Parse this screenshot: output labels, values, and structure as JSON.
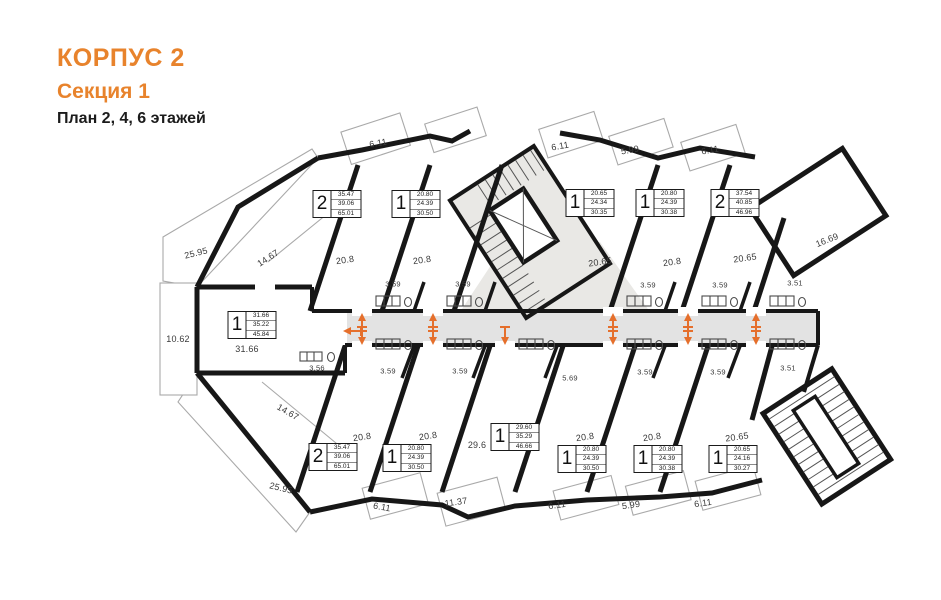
{
  "header": {
    "building": "КОРПУС 2",
    "section": "Секция 1",
    "plan": "План 2, 4, 6 этажей",
    "accent_color": "#E8832C"
  },
  "plan": {
    "arrow_color": "#E56F2C",
    "corridor_color": "#E3E3E3",
    "stair_color": "#E9E8E5",
    "wall_color": "#171717",
    "apartments": [
      {
        "rooms": "2",
        "areas": [
          "35.47",
          "39.06",
          "65.01"
        ],
        "x": 337,
        "y": 204
      },
      {
        "rooms": "1",
        "areas": [
          "20.80",
          "24.39",
          "30.50"
        ],
        "x": 416,
        "y": 204
      },
      {
        "rooms": "1",
        "areas": [
          "20.65",
          "24.34",
          "30.35"
        ],
        "x": 590,
        "y": 203
      },
      {
        "rooms": "1",
        "areas": [
          "20.80",
          "24.39",
          "30.38"
        ],
        "x": 660,
        "y": 203
      },
      {
        "rooms": "2",
        "areas": [
          "37.54",
          "40.85",
          "46.96"
        ],
        "x": 735,
        "y": 203
      },
      {
        "rooms": "1",
        "areas": [
          "31.66",
          "35.22",
          "45.84"
        ],
        "x": 252,
        "y": 325
      },
      {
        "rooms": "1",
        "areas": [
          "29.60",
          "35.29",
          "46.66"
        ],
        "x": 515,
        "y": 437
      },
      {
        "rooms": "2",
        "areas": [
          "35.47",
          "39.06",
          "65.01"
        ],
        "x": 333,
        "y": 457
      },
      {
        "rooms": "1",
        "areas": [
          "20.80",
          "24.39",
          "30.50"
        ],
        "x": 407,
        "y": 458
      },
      {
        "rooms": "1",
        "areas": [
          "20.80",
          "24.39",
          "30.50"
        ],
        "x": 582,
        "y": 459
      },
      {
        "rooms": "1",
        "areas": [
          "20.80",
          "24.39",
          "30.38"
        ],
        "x": 658,
        "y": 459
      },
      {
        "rooms": "1",
        "areas": [
          "20.65",
          "24.16",
          "30.27"
        ],
        "x": 733,
        "y": 459
      }
    ],
    "labels": [
      {
        "kind": "dim",
        "t": "6.11",
        "x": 378,
        "y": 143,
        "r": -10
      },
      {
        "kind": "dim",
        "t": "6.11",
        "x": 560,
        "y": 146,
        "r": -10
      },
      {
        "kind": "dim",
        "t": "5.99",
        "x": 630,
        "y": 150,
        "r": -10
      },
      {
        "kind": "dim",
        "t": "6.11",
        "x": 710,
        "y": 150,
        "r": -10
      },
      {
        "kind": "dim",
        "t": "25.95",
        "x": 196,
        "y": 253,
        "r": -14
      },
      {
        "kind": "dim",
        "t": "14.67",
        "x": 268,
        "y": 258,
        "r": -33
      },
      {
        "kind": "dim",
        "t": "10.62",
        "x": 178,
        "y": 339,
        "r": 0
      },
      {
        "kind": "dim",
        "t": "31.66",
        "x": 247,
        "y": 349,
        "r": 0
      },
      {
        "kind": "dim",
        "t": "14.67",
        "x": 288,
        "y": 412,
        "r": 30
      },
      {
        "kind": "dim",
        "t": "25.95",
        "x": 281,
        "y": 488,
        "r": 14
      },
      {
        "kind": "dim",
        "t": "6.11",
        "x": 382,
        "y": 507,
        "r": 10
      },
      {
        "kind": "dim",
        "t": "11.37",
        "x": 456,
        "y": 502,
        "r": -8
      },
      {
        "kind": "dim",
        "t": "6.11",
        "x": 557,
        "y": 505,
        "r": -8
      },
      {
        "kind": "dim",
        "t": "5.99",
        "x": 631,
        "y": 505,
        "r": -8
      },
      {
        "kind": "dim",
        "t": "6.11",
        "x": 703,
        "y": 503,
        "r": -8
      },
      {
        "kind": "dim",
        "t": "16.69",
        "x": 827,
        "y": 240,
        "r": -22
      },
      {
        "kind": "room",
        "t": "20.8",
        "x": 345,
        "y": 260,
        "r": -8
      },
      {
        "kind": "room",
        "t": "20.8",
        "x": 422,
        "y": 260,
        "r": -8
      },
      {
        "kind": "room",
        "t": "20.65",
        "x": 600,
        "y": 262,
        "r": -8
      },
      {
        "kind": "room",
        "t": "20.8",
        "x": 672,
        "y": 262,
        "r": -8
      },
      {
        "kind": "room",
        "t": "20.65",
        "x": 745,
        "y": 258,
        "r": -8
      },
      {
        "kind": "room",
        "t": "20.8",
        "x": 362,
        "y": 437,
        "r": -8
      },
      {
        "kind": "room",
        "t": "20.8",
        "x": 428,
        "y": 436,
        "r": -8
      },
      {
        "kind": "room",
        "t": "29.6",
        "x": 477,
        "y": 445,
        "r": 0
      },
      {
        "kind": "room",
        "t": "20.8",
        "x": 585,
        "y": 437,
        "r": -8
      },
      {
        "kind": "room",
        "t": "20.8",
        "x": 652,
        "y": 437,
        "r": -8
      },
      {
        "kind": "room",
        "t": "20.65",
        "x": 737,
        "y": 437,
        "r": -8
      },
      {
        "kind": "bath",
        "t": "3.59",
        "x": 393,
        "y": 284,
        "r": 0
      },
      {
        "kind": "bath",
        "t": "3.59",
        "x": 463,
        "y": 284,
        "r": 0
      },
      {
        "kind": "bath",
        "t": "3.59",
        "x": 648,
        "y": 285,
        "r": 0
      },
      {
        "kind": "bath",
        "t": "3.59",
        "x": 720,
        "y": 285,
        "r": 0
      },
      {
        "kind": "bath",
        "t": "3.51",
        "x": 795,
        "y": 283,
        "r": 0
      },
      {
        "kind": "bath",
        "t": "3.56",
        "x": 317,
        "y": 368,
        "r": 0
      },
      {
        "kind": "bath",
        "t": "3.59",
        "x": 388,
        "y": 371,
        "r": 0
      },
      {
        "kind": "bath",
        "t": "3.59",
        "x": 460,
        "y": 371,
        "r": 0
      },
      {
        "kind": "bath",
        "t": "3.59",
        "x": 645,
        "y": 372,
        "r": 0
      },
      {
        "kind": "bath",
        "t": "3.59",
        "x": 718,
        "y": 372,
        "r": 0
      },
      {
        "kind": "bath",
        "t": "3.51",
        "x": 788,
        "y": 368,
        "r": 0
      },
      {
        "kind": "bath",
        "t": "5.69",
        "x": 570,
        "y": 378,
        "r": 0
      }
    ],
    "arrows": [
      {
        "d": "left",
        "x": 352,
        "y": 331
      },
      {
        "d": "up",
        "x": 362,
        "y": 322
      },
      {
        "d": "up",
        "x": 433,
        "y": 322
      },
      {
        "d": "up",
        "x": 613,
        "y": 322
      },
      {
        "d": "up",
        "x": 688,
        "y": 322
      },
      {
        "d": "up",
        "x": 756,
        "y": 322
      },
      {
        "d": "down",
        "x": 362,
        "y": 336
      },
      {
        "d": "down",
        "x": 433,
        "y": 336
      },
      {
        "d": "down",
        "x": 505,
        "y": 336
      },
      {
        "d": "down",
        "x": 613,
        "y": 336
      },
      {
        "d": "down",
        "x": 688,
        "y": 336
      },
      {
        "d": "down",
        "x": 756,
        "y": 336
      }
    ]
  }
}
